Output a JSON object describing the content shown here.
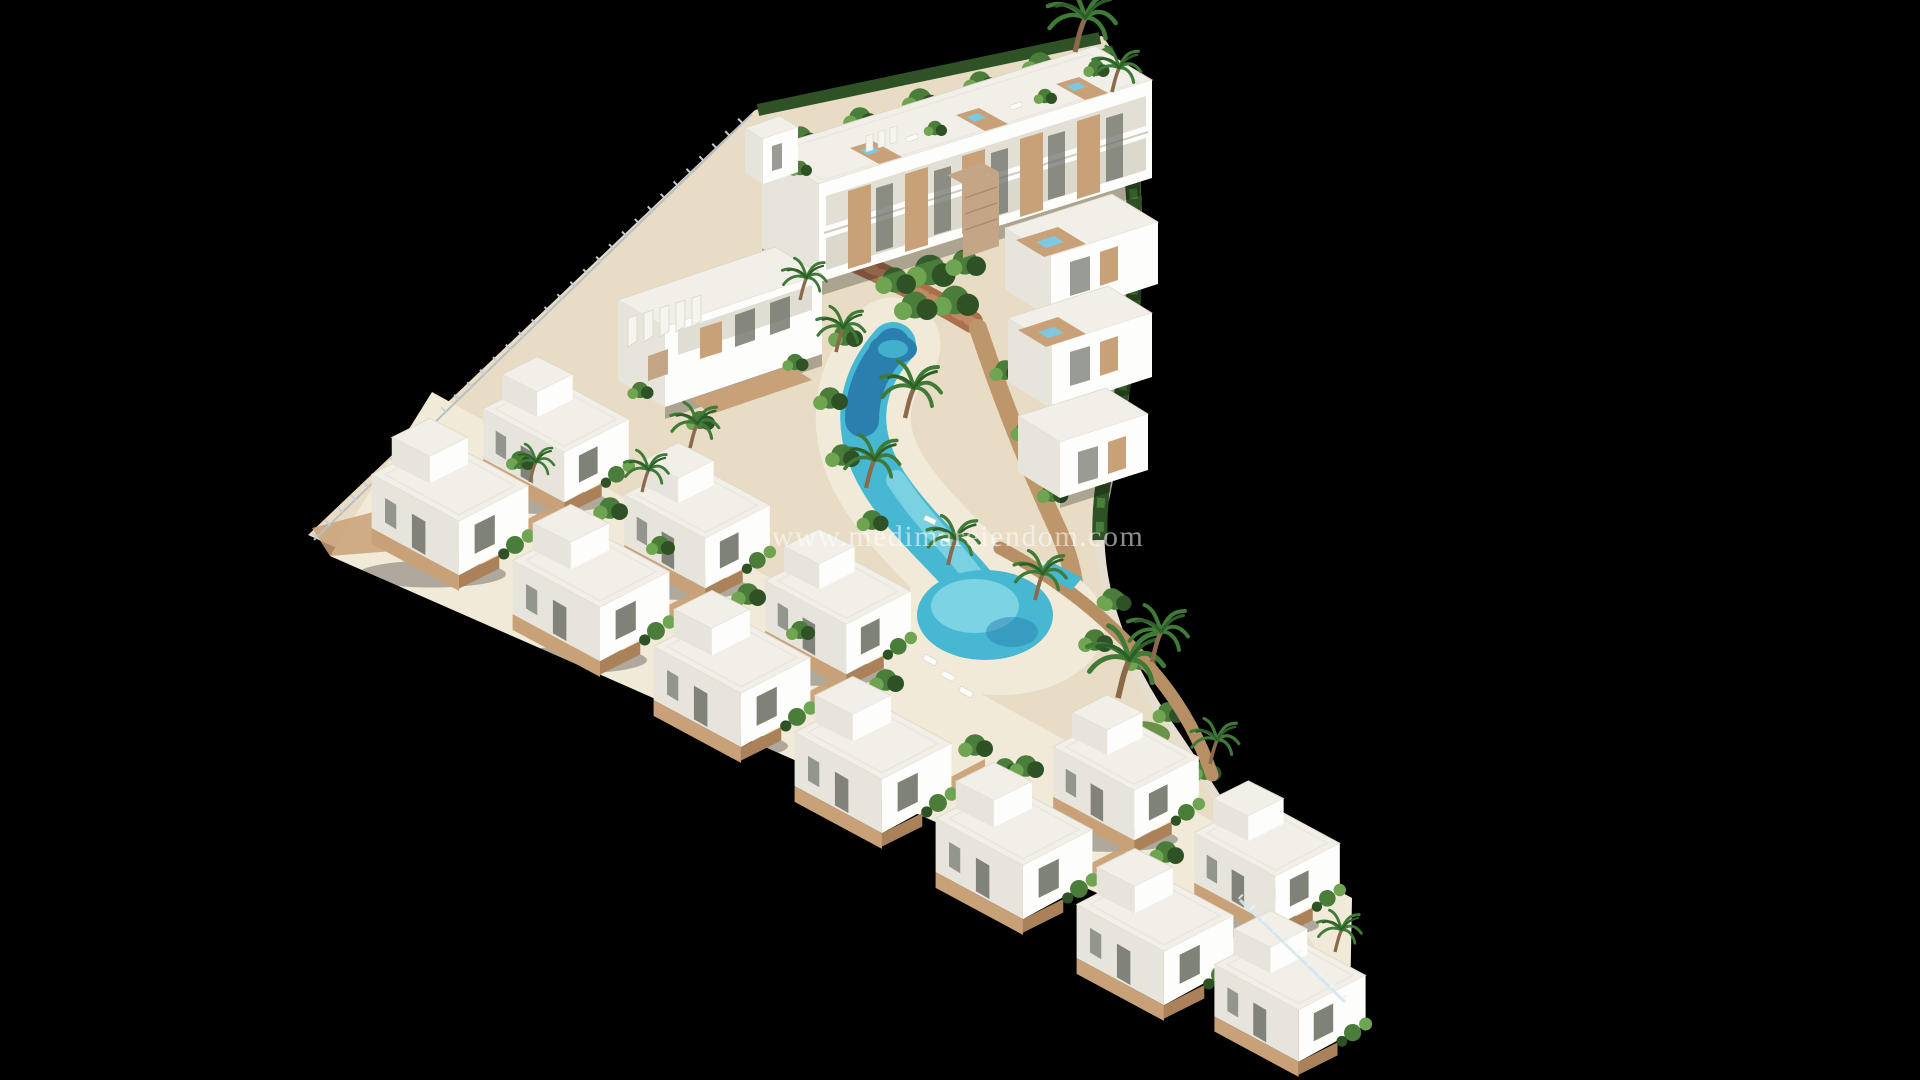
{
  "scene": {
    "type": "architectural-render",
    "title": "Aerial 3D visualization of a triangular seaside residential development",
    "watermark": "www.medimareiendom.com",
    "background": "#000000",
    "features": [
      "modern white apartment block with rooftop wood decks and plunge jacuzzis",
      "stepped hillside apartment terraces with rooftop jacuzzis",
      "two staggered rows of white cubic villas with wooden pergola decks",
      "winding lagoon-style communal pool with sandy beach entry",
      "curved timber boardwalk and terracotta garden path",
      "palm trees, shrubs and tropical landscaping",
      "perimeter hedge, white walls, picket and glass fencing"
    ],
    "colors": {
      "bg": "#000000",
      "sand": "#e8dcc4",
      "sand-light": "#f2ead8",
      "white": "#fdfdfb",
      "white-face": "#f6f4ee",
      "white-shade": "#e7e4db",
      "roof": "#f1efe7",
      "deck-wood": "#c9a178",
      "wood-dark": "#ab815a",
      "stone": "#c4a687",
      "terracotta": "#ab6f4c",
      "pool-deep": "#2a7fae",
      "pool-main": "#47b8d2",
      "pool-light": "#8adae6",
      "jacuzzi": "#7cc9e0",
      "green-dark": "#2e5226",
      "green": "#4a7c3a",
      "green-light": "#6fa451",
      "grass": "#5c8a3c",
      "fence": "#b7bec4",
      "wall": "#e6dfcf",
      "glass": "#d6e7ee",
      "watermark": "#ffffff"
    }
  }
}
